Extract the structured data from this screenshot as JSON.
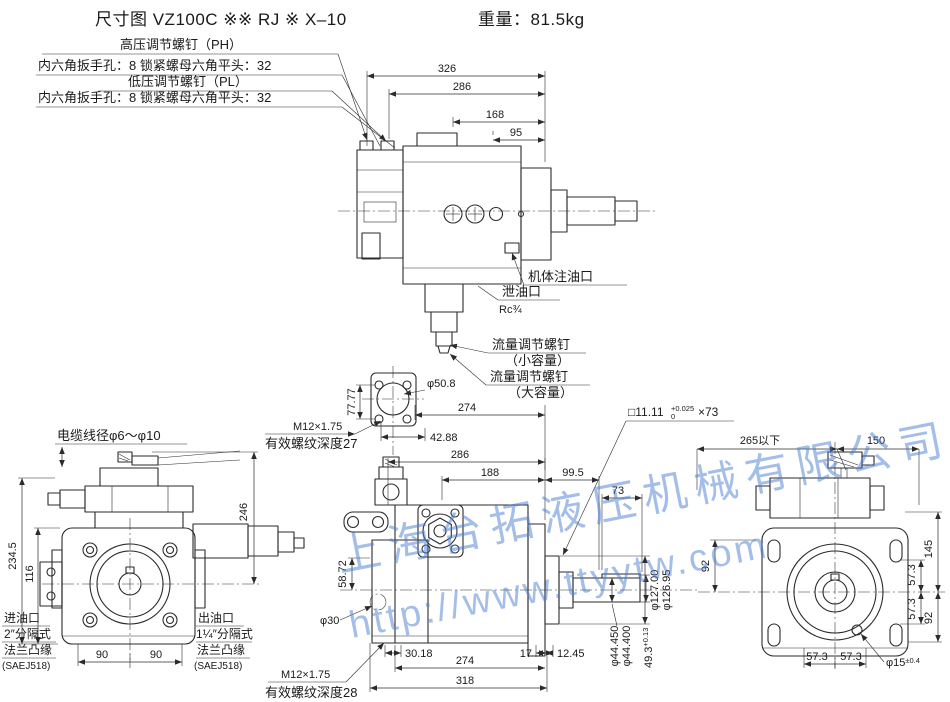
{
  "title": {
    "text": "尺寸图  VZ100C ※※ RJ ※ X–10",
    "weight": "重量：81.5kg"
  },
  "watermark": {
    "company": "上海台拓液压机械有限公司",
    "url": "http://www.ttyytw.com"
  },
  "top_view": {
    "callout_ph": "高压调节螺钉（PH）",
    "callout_hex1": "内六角扳手孔：8  锁紧螺母六角平头：32",
    "callout_pl": "低压调节螺钉（PL）",
    "callout_hex2": "内六角扳手孔：8  锁紧螺母六角平头：32",
    "callout_fill": "机体注油口",
    "callout_drain": "泄油口",
    "callout_drain_size": "Rc¾",
    "flow_small_line1": "流量调节螺钉",
    "flow_small_line2": "（小容量）",
    "flow_large_line1": "流量调节螺钉",
    "flow_large_line2": "（大容量）",
    "dim_326": "326",
    "dim_286": "286",
    "dim_168": "168",
    "dim_95": "95"
  },
  "flange_view": {
    "dim_7777": "77.77",
    "dim_pilot": "φ50.8",
    "dim_4288": "42.88",
    "dim_274": "274",
    "thread": "M12×1.75",
    "thread_note": "有效螺纹深度27"
  },
  "lower_view": {
    "dim_286": "286",
    "dim_188": "188",
    "dim_995": "99.5",
    "dim_73": "73",
    "dim_5872": "58.72",
    "dim_phi30": "φ30",
    "dim_3018": "30.18",
    "dim_17": "17",
    "dim_1245": "12.45",
    "dim_274": "274",
    "dim_318": "318",
    "dim_pilot_max": "φ127.00",
    "dim_pilot_min": "φ126.95",
    "dim_shaft_max": "φ44.450",
    "dim_shaft_min": "φ44.400",
    "dim_493": "49.3",
    "dim_493_tol": "+0.13",
    "key_size": "□11.11",
    "key_tol_up": "+0.025",
    "key_tol_dn": "0",
    "key_len": "×73",
    "thread": "M12×1.75",
    "thread_note": "有效螺纹深度28"
  },
  "front_view": {
    "callout_cable": "电缆线径φ6～φ10",
    "dim_2345": "234.5",
    "dim_116": "116",
    "dim_246": "246",
    "dim_90a": "90",
    "dim_90b": "90",
    "inlet": [
      "进油口",
      "2″分隔式",
      "法兰凸缘",
      "(SAEJ518)"
    ],
    "outlet": [
      "出油口",
      "1¼″分隔式",
      "法兰凸缘",
      "(SAEJ518)"
    ]
  },
  "rear_view": {
    "dim_265": "265以下",
    "dim_150": "150",
    "dim_92l": "92",
    "dim_145": "145",
    "dim_573a": "57.3",
    "dim_573b": "57.3",
    "dim_92r": "92",
    "dim_573c": "57.3",
    "dim_573d": "57.3",
    "dim_phi15": "φ15",
    "dim_phi15_tol": "±0.4"
  }
}
